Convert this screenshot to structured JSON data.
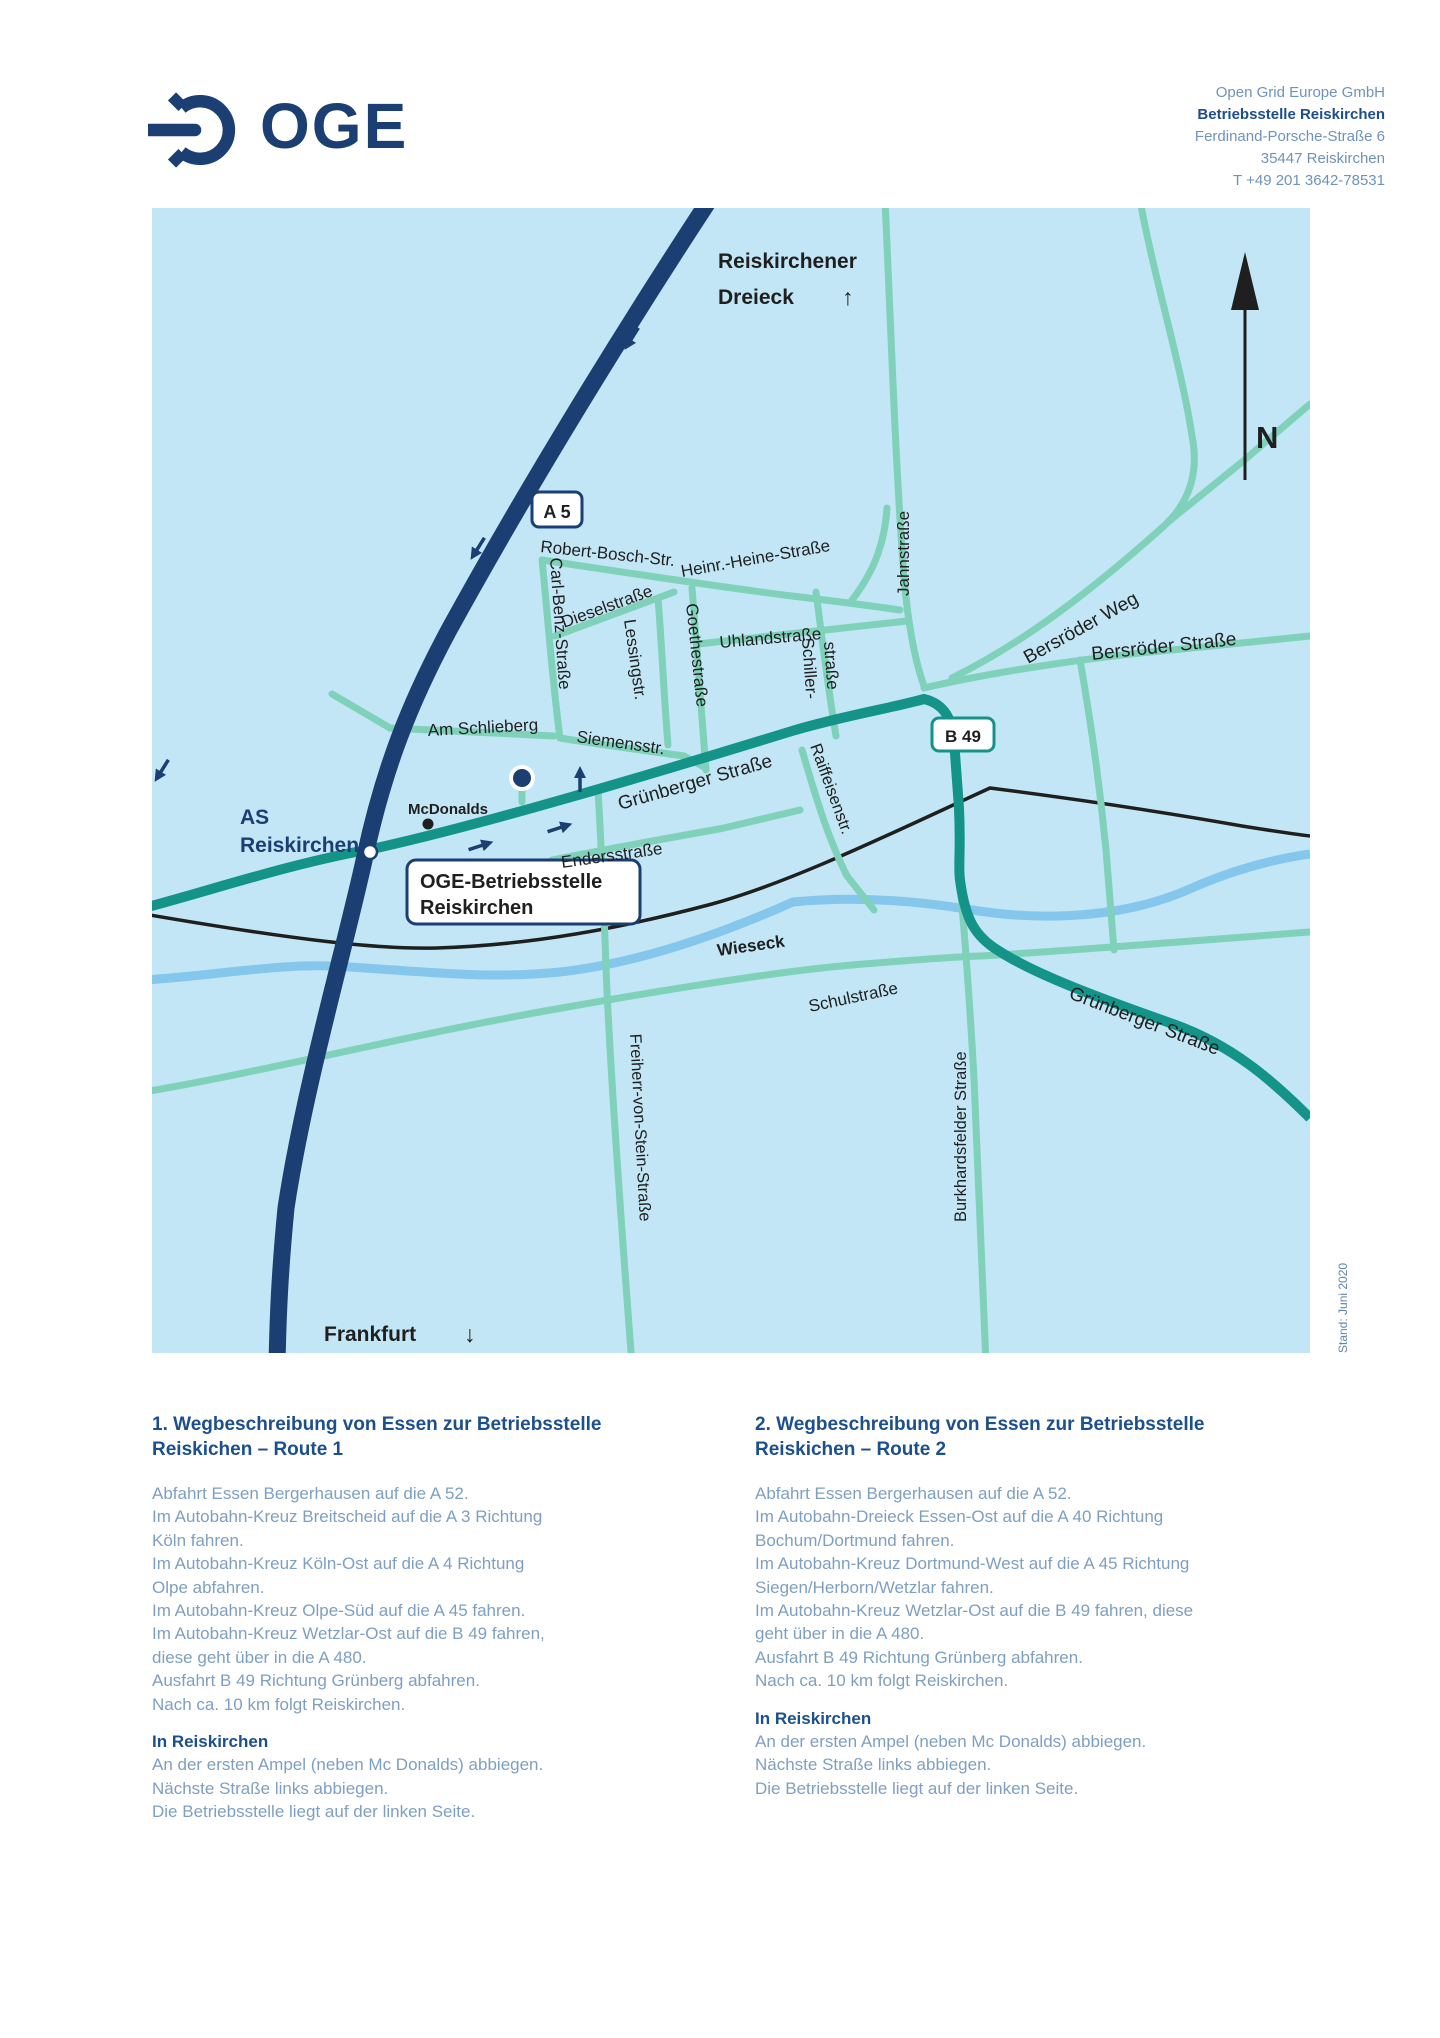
{
  "header": {
    "logo_text": "OGE",
    "address": {
      "company": "Open Grid Europe GmbH",
      "site": "Betriebsstelle Reiskirchen",
      "street": "Ferdinand-Porsche-Straße 6",
      "city": "35447 Reiskirchen",
      "phone": "T +49 201 3642-78531"
    }
  },
  "map": {
    "colors": {
      "map_bg": "#c2e6f5",
      "motorway_navy": "#1b3e73",
      "road_teal_light": "#7fd1b9",
      "road_teal_dark": "#149388",
      "river_blue": "#85c6ec",
      "railway_black": "#1f1f1f"
    },
    "labels": {
      "dreieck_line1": "Reiskirchener",
      "dreieck_line2": "Dreieck",
      "dreieck_arrow": "↑",
      "north": "N",
      "a5_shield": "A 5",
      "b49_shield": "B 49",
      "as_line1": "AS",
      "as_line2": "Reiskirchen",
      "mcdonalds": "McDonalds",
      "oge_box_line1": "OGE-Betriebsstelle",
      "oge_box_line2": "Reiskirchen",
      "frankfurt": "Frankfurt",
      "frankfurt_arrow": "↓",
      "wieseck": "Wieseck"
    },
    "streets": {
      "robert_bosch": "Robert-Bosch-Str.",
      "heine": "Heinr.-Heine-Straße",
      "carl_benz": "Carl-Benz-Straße",
      "diesel": "Dieselstraße",
      "lessing": "Lessingstr.",
      "goethe": "Goethestraße",
      "uhland": "Uhlandstraße",
      "schiller_line1": "Schiller-",
      "schiller_line2": "straße",
      "am_schlieberg": "Am Schlieberg",
      "siemens": "Siemensstr.",
      "gruenberger": "Grünberger Straße",
      "enders": "Endersstraße",
      "raiffeisen": "Raiffeisenstr.",
      "jahn": "Jahnstraße",
      "bersroeder_weg": "Bersröder Weg",
      "bersroeder_str": "Bersröder Straße",
      "schul": "Schulstraße",
      "freiherr": "Freiherr-von-Stein-Straße",
      "burkhard": "Burkhardsfelder Straße",
      "gruenberger_sued": "Grünberger Straße"
    }
  },
  "stand_note": "Stand: Juni 2020",
  "routes": [
    {
      "title_line1": "1. Wegbeschreibung von Essen zur Betriebsstelle",
      "title_line2": "Reiskichen – Route 1",
      "lines": [
        "Abfahrt Essen Bergerhausen auf die A 52.",
        "Im Autobahn-Kreuz Breitscheid auf die A 3 Richtung",
        "Köln fahren.",
        "Im Autobahn-Kreuz Köln-Ost auf die A 4 Richtung",
        "Olpe abfahren.",
        "Im Autobahn-Kreuz Olpe-Süd auf die A 45 fahren.",
        "Im Autobahn-Kreuz Wetzlar-Ost auf die B 49 fahren,",
        "diese geht über in die A 480.",
        "Ausfahrt B 49 Richtung Grünberg abfahren.",
        "Nach ca. 10 km folgt Reiskirchen."
      ],
      "sub_title": "In Reiskirchen",
      "sub_lines": [
        "An der ersten Ampel (neben Mc Donalds) abbiegen.",
        "Nächste Straße links abbiegen.",
        "Die Betriebsstelle liegt auf der linken Seite."
      ]
    },
    {
      "title_line1": "2. Wegbeschreibung von Essen zur Betriebsstelle",
      "title_line2": "Reiskichen – Route 2",
      "lines": [
        "Abfahrt Essen Bergerhausen auf die A 52.",
        "Im Autobahn-Dreieck Essen-Ost auf die A 40 Richtung",
        "Bochum/Dortmund fahren.",
        "Im Autobahn-Kreuz Dortmund-West auf die A 45 Richtung",
        "Siegen/Herborn/Wetzlar fahren.",
        "Im Autobahn-Kreuz Wetzlar-Ost auf die B 49 fahren, diese",
        "geht über in die A 480.",
        "Ausfahrt B 49 Richtung Grünberg abfahren.",
        "Nach ca. 10 km folgt Reiskirchen."
      ],
      "sub_title": "In Reiskirchen",
      "sub_lines": [
        "An der ersten Ampel (neben Mc Donalds) abbiegen.",
        "Nächste Straße links abbiegen.",
        "Die Betriebsstelle liegt auf der linken Seite."
      ]
    }
  ]
}
